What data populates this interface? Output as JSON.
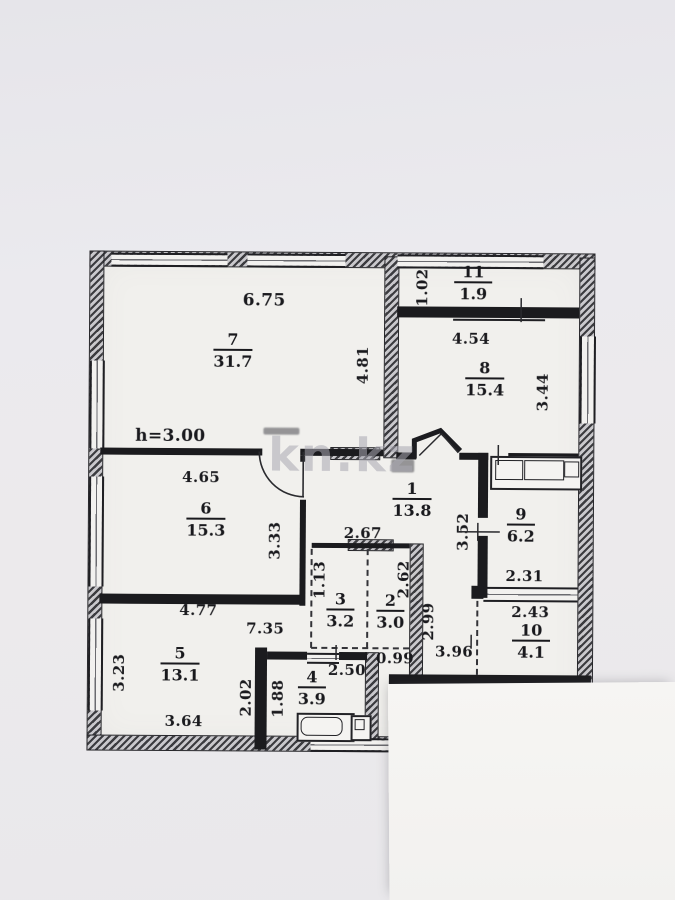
{
  "watermark": "kn.kz",
  "plan": {
    "ceiling_height": "h=3.00",
    "rooms": {
      "r1": {
        "number": "1",
        "area": "13.8"
      },
      "r2": {
        "number": "2",
        "area": "3.0"
      },
      "r3": {
        "number": "3",
        "area": "3.2"
      },
      "r4": {
        "number": "4",
        "area": "3.9"
      },
      "r5": {
        "number": "5",
        "area": "13.1"
      },
      "r6": {
        "number": "6",
        "area": "15.3"
      },
      "r7": {
        "number": "7",
        "area": "31.7"
      },
      "r8": {
        "number": "8",
        "area": "15.4"
      },
      "r9": {
        "number": "9",
        "area": "6.2"
      },
      "r10": {
        "number": "10",
        "area": "4.1"
      },
      "r11": {
        "number": "11",
        "area": "1.9"
      }
    },
    "dimensions": {
      "room7_width": "6.75",
      "room7_depth": "4.81",
      "balcony_width": "1.02",
      "room8_width": "4.54",
      "room8_depth": "3.44",
      "room6_width": "4.65",
      "room6_depth": "3.33",
      "hall_width": "2.67",
      "hall_depth": "3.52",
      "room9_width_inner": "2.31",
      "room9_width_outer": "2.43",
      "room3_depth": "1.13",
      "room2_depth_upper": "2.62",
      "room2_depth_full": "2.99",
      "room5_width_top": "4.77",
      "corridor_length": "7.35",
      "room5_depth": "3.23",
      "room5_width_bottom": "3.64",
      "room4_depth_outer": "2.02",
      "room4_depth": "1.88",
      "room4_width": "2.50",
      "gap_width": "0.99",
      "corridor2_width": "3.96"
    }
  }
}
